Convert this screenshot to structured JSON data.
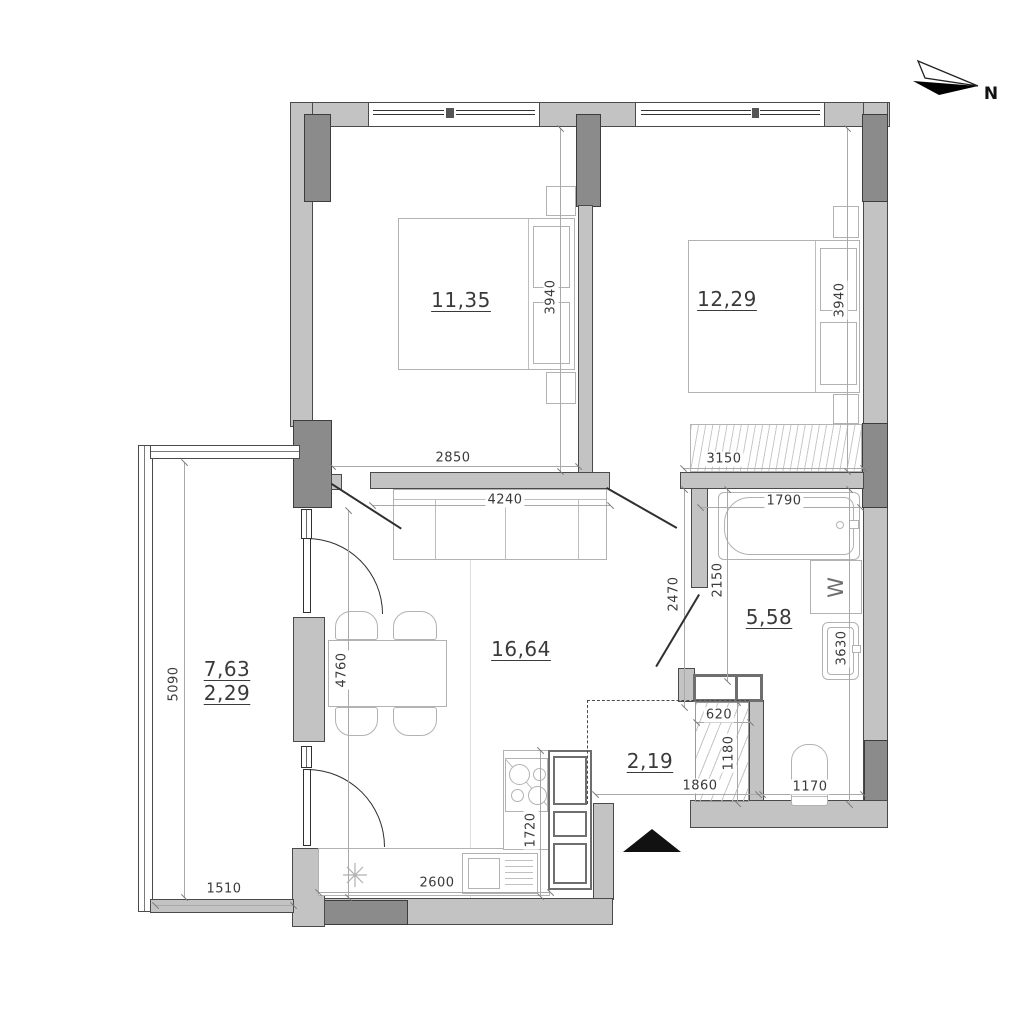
{
  "title": "apartment-floor-plan",
  "compass": {
    "label": "N"
  },
  "rooms": {
    "bedroom1": {
      "name": "bedroom-1",
      "area": "11,35"
    },
    "bedroom2": {
      "name": "bedroom-2",
      "area": "12,29"
    },
    "living": {
      "name": "living-kitchen",
      "area": "16,64"
    },
    "bathroom": {
      "name": "bathroom",
      "area": "5,58"
    },
    "hall": {
      "name": "entry-hall",
      "area": "2,19"
    },
    "balcony": {
      "name": "balcony",
      "area_total": "7,63",
      "area_counted": "2,29"
    }
  },
  "dims": {
    "d2850": "2850",
    "d4240": "4240",
    "d3150": "3150",
    "d1790": "1790",
    "d3940a": "3940",
    "d3940b": "3940",
    "d2470": "2470",
    "d2150": "2150",
    "d3630": "3630",
    "d620": "620",
    "d1180": "1180",
    "d1860": "1860",
    "d1170": "1170",
    "d5090": "5090",
    "d4760": "4760",
    "d1510": "1510",
    "d2600": "2600",
    "d1720": "1720"
  },
  "appliances": {
    "washer": "W"
  },
  "colors": {
    "wall_light": "#c3c3c3",
    "wall_dark": "#8b8b8b",
    "outline": "#4a4a4a",
    "furniture_line": "#b2b2b2",
    "entrance_marker": "#111111"
  }
}
